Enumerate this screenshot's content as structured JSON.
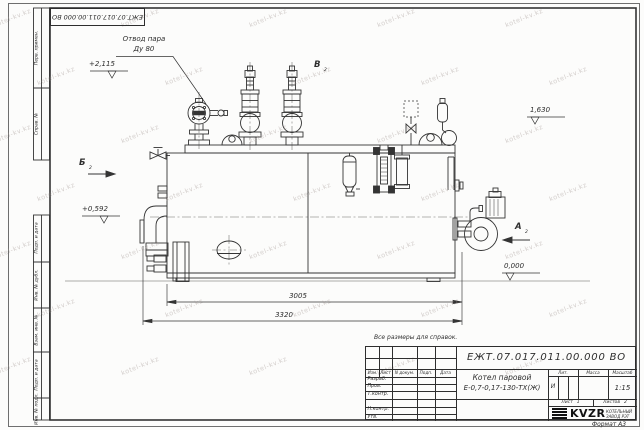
{
  "doc_number": "ЕЖТ.07.017.011.00.000 ВО",
  "watermark": {
    "text": "kotel-kv.kz"
  },
  "margin_labels": {
    "perv": "Перв. примен.",
    "sprav": "Справ. №",
    "podp1": "Подп. и дата",
    "inv_dubl": "Инв. № дубл.",
    "vzam": "Взам. инв. №",
    "podp2": "Подп. и дата",
    "inv_podl": "Инв. № подл."
  },
  "annotations": {
    "steam_line1": "Отвод пара",
    "steam_line2": "Ду 80",
    "elev_top_left": "+2,115",
    "elev_top_right": "1,630",
    "elev_mid_left": "+0,592",
    "elev_zero": "0,000",
    "dim_inner": "3005",
    "dim_outer": "3320",
    "view_a": "А",
    "view_b": "Б",
    "view_v": "В",
    "view_sheet_ref": "2"
  },
  "note": "Все размеры для справок.",
  "title_block": {
    "header": {
      "izm": "Изм.",
      "list": "Лист",
      "ndokum": "N докум.",
      "podp": "Подп.",
      "data": "Дата"
    },
    "rows": {
      "razrab": "Разраб.",
      "prov": "Пров.",
      "tkontr": "Т.контр.",
      "nkontr": "Н.контр.",
      "utv": "Утв."
    },
    "product_line1": "Котел паровой",
    "product_line2": "Е-0,7-0,17-130-ТХ(Ж)",
    "lit_header": "Лит.",
    "lit_value": "И",
    "mass_header": "Масса",
    "scale_header": "Масштаб",
    "scale_value": "1:15",
    "sheet_label": "Лист",
    "sheet_value": "1",
    "sheets_label": "Листов",
    "sheets_value": "2",
    "company": {
      "logo": "KVZR",
      "name_line1": "КОТЕЛЬНЫЙ",
      "name_line2": "ЗАВОД РЭТ"
    },
    "format": "Формат А3"
  }
}
